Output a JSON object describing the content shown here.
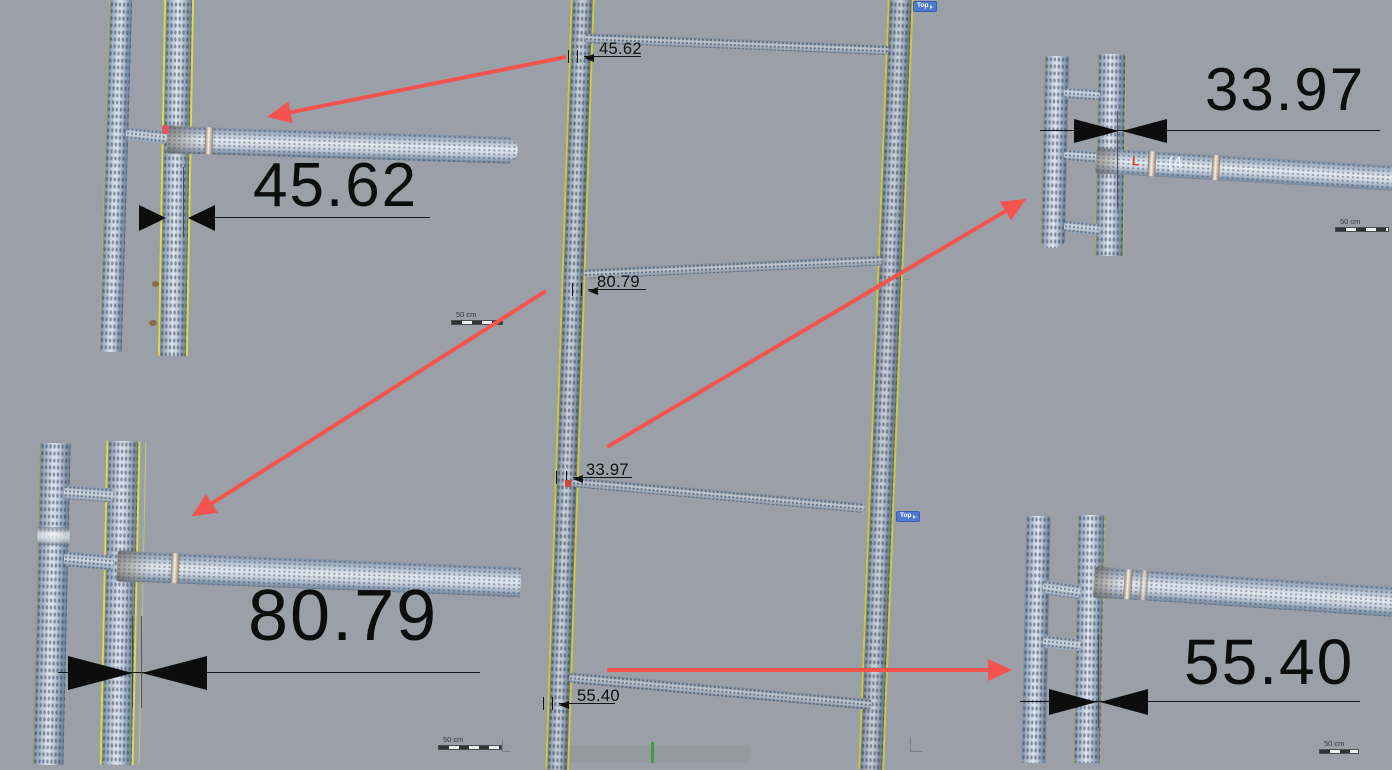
{
  "colors": {
    "background": "#9ba0a8",
    "callout_arrow_red": "#f5534e",
    "guide_line_yellow": "#ddd93c",
    "dimension_black": "#0d0d0d",
    "badge_blue": "#4f79cf",
    "axis_green": "#3c9e44",
    "bottom_panel_gray": "#96999e",
    "pipe_highlight": "#dde5ee",
    "pipe_shadow": "#708195"
  },
  "center": {
    "top_view": {
      "badge": "Top",
      "scale_bar": "50 cm",
      "dims": [
        {
          "value": "45.62"
        },
        {
          "value": "80.79"
        }
      ]
    },
    "bottom_view": {
      "badge": "Top",
      "scale_bar": "50 cm",
      "dims": [
        {
          "value": "33.97"
        },
        {
          "value": "55.40"
        }
      ]
    }
  },
  "insets": {
    "top_left": {
      "dim": "45.62"
    },
    "top_right": {
      "dim": "33.97",
      "scale_bar": "50 cm",
      "pipe_paint_mark": "(4",
      "red_paint_mark": "L"
    },
    "bottom_left": {
      "dim": "80.79"
    },
    "bottom_right": {
      "dim": "55.40",
      "scale_bar": "50 cm"
    }
  }
}
